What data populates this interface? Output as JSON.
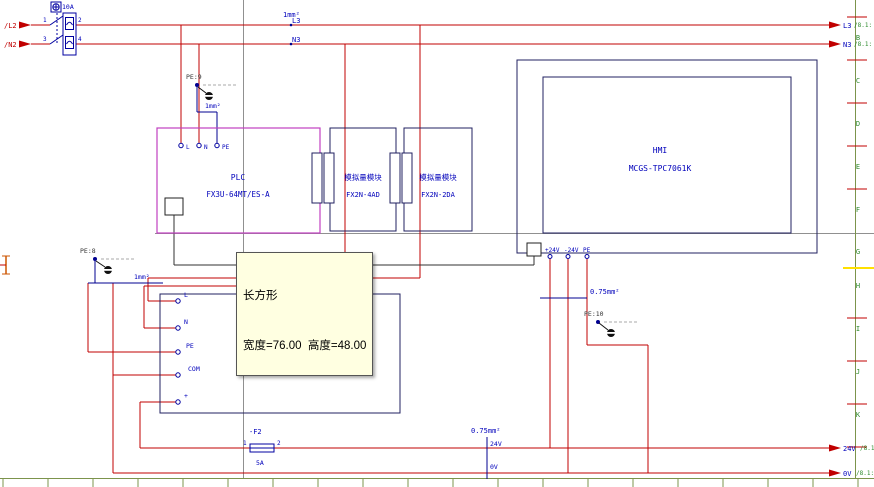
{
  "frame": {
    "row_letters": [
      "B",
      "C",
      "D",
      "E",
      "F",
      "G",
      "H",
      "I",
      "J",
      "K"
    ]
  },
  "source": {
    "l2": "/L2",
    "n2": "/N2"
  },
  "breaker": {
    "rating": "10A",
    "pin1": "1",
    "pin2": "2",
    "pin3": "3",
    "pin4": "4"
  },
  "nets": {
    "l3": "L3",
    "n3": "N3",
    "v24": "24V",
    "v0": "0V"
  },
  "refs": {
    "l3": "/8.1:",
    "n3": "/8.1:",
    "v24": "/8.1:",
    "v0": "/8.1:"
  },
  "sizes": {
    "top": "1mm²",
    "pe9": "1mm²",
    "pe8": "1mm²",
    "pe10": "0.75mm²",
    "bottom": "0.75mm²"
  },
  "pe_refs": {
    "pe9": "PE:9",
    "pe8": "PE:8",
    "pe10": "PE:10"
  },
  "plc": {
    "title": "PLC",
    "model": "FX3U-64MT/ES-A",
    "term_l": "L",
    "term_n": "N",
    "term_pe": "PE"
  },
  "modules": [
    {
      "title": "模拟量模块",
      "model": "FX2N-4AD"
    },
    {
      "title": "模拟量模块",
      "model": "FX2N-2DA"
    }
  ],
  "hmi": {
    "title": "HMI",
    "model": "MCGS-TPC7061K",
    "term1": "+24V",
    "term2": "-24V",
    "term3": "PE"
  },
  "psu": {
    "title": "DC24V开关电源",
    "model": "AC220-DC24 S-100-24",
    "term_l": "L",
    "term_n": "N",
    "term_pe": "PE",
    "term_com": "COM",
    "term_plus": "+"
  },
  "fuse": {
    "tag": "-F2",
    "rating": "5A",
    "pin1": "1",
    "pin2": "2"
  },
  "tooltip": {
    "title": "长方形",
    "detail": "宽度=76.00  高度=48.00"
  },
  "colors": {
    "wire_red": "#c00000",
    "component_outline": "#202060",
    "device_text": "#0000bb",
    "plc_border": "#c040c0",
    "breaker_blue": "#0000a0",
    "pe_wire_navy": "#000090",
    "frame_green": "#7c944c",
    "ref_green": "#2e8b2e",
    "tooltip_bg": "#ffffe1",
    "construction_gray": "#909090",
    "highlight_yellow": "#ffe000"
  }
}
